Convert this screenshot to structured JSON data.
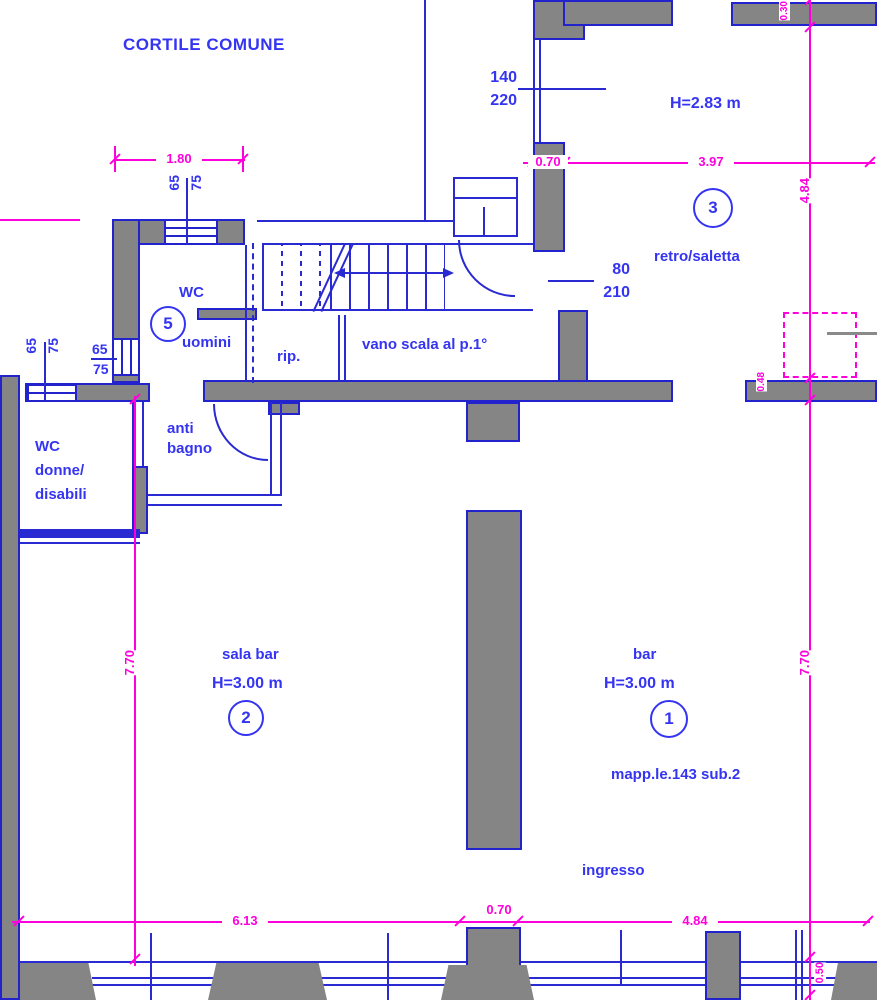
{
  "colors": {
    "wall_fill": "#858585",
    "line_blue": "#2a2ad2",
    "text_blue": "#3434f2",
    "magenta": "#ff00dd"
  },
  "labels": {
    "cortile": "CORTILE COMUNE",
    "retro": "retro/saletta",
    "retro_num": "3",
    "retro_h": "H=2.83 m",
    "door140": "140",
    "door220": "220",
    "door80": "80",
    "door210": "210",
    "wc": "WC",
    "wc_num": "5",
    "uomini": "uomini",
    "rip": "rip.",
    "vano_scala": "vano scala al p.1°",
    "anti1": "anti",
    "anti2": "bagno",
    "donne1": "WC",
    "donne2": "donne/",
    "donne3": "disabili",
    "sala_bar": "sala bar",
    "sala_h": "H=3.00 m",
    "sala_num": "2",
    "bar": "bar",
    "bar_h": "H=3.00 m",
    "bar_num": "1",
    "mappale": "mapp.le.143 sub.2",
    "ingresso": "ingresso",
    "w65": "65",
    "w75": "75"
  },
  "dims": {
    "d180": "1.80",
    "d070t": "0.70",
    "d397": "3.97",
    "d484r": "4.84",
    "d030": "0.30",
    "d048": "0.48",
    "d770l": "7.70",
    "d770r": "7.70",
    "d613": "6.13",
    "d070b": "0.70",
    "d484b": "4.84",
    "d050": "0.50"
  }
}
